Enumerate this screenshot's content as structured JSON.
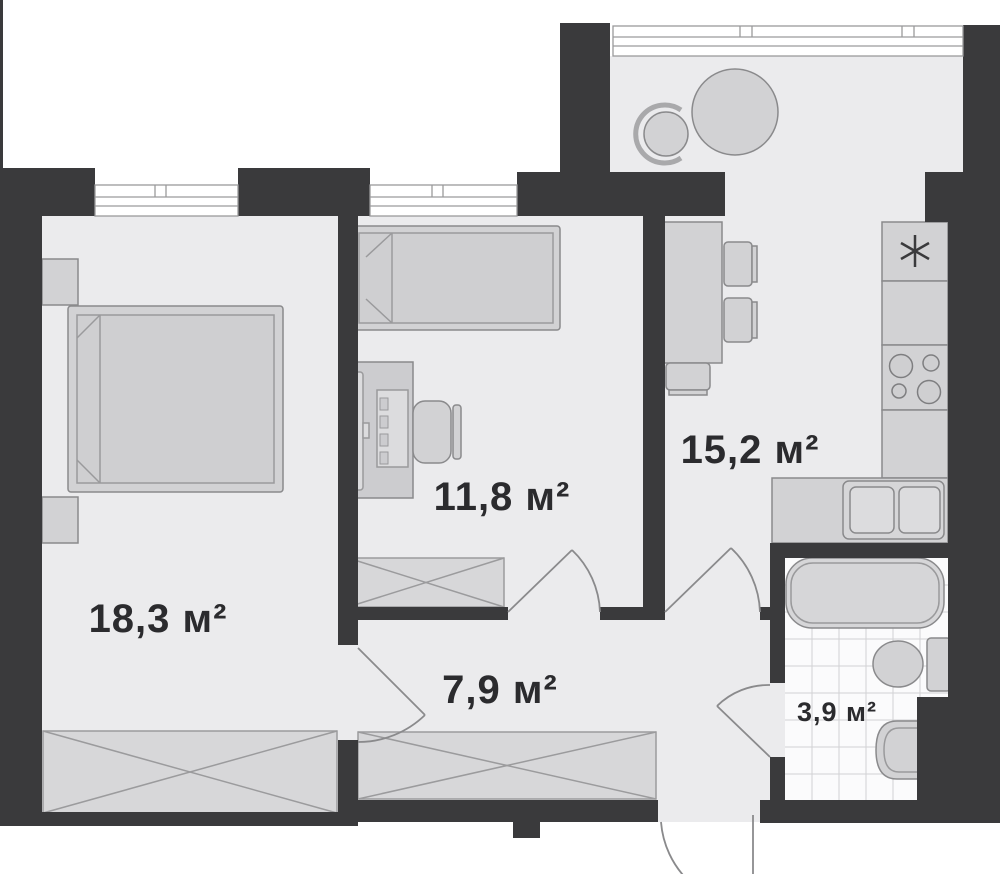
{
  "plan": {
    "type": "apartment-floor-plan",
    "colors": {
      "background": "#ffffff",
      "wall": "#3a3a3c",
      "floor": "#ebebed",
      "bathroom_floor": "#fbfbfc",
      "tile_line": "#d2d2d4",
      "furniture_fill": "#d2d2d4",
      "furniture_stroke": "#8a8a8c",
      "closet_fill": "#d7d7d9",
      "label_color": "#2b2b2e"
    },
    "rooms": [
      {
        "id": "bedroom",
        "area_label": "18,3 м²"
      },
      {
        "id": "office-bedroom",
        "area_label": "11,8 м²"
      },
      {
        "id": "kitchen-living",
        "area_label": "15,2 м²"
      },
      {
        "id": "hallway",
        "area_label": "7,9 м²"
      },
      {
        "id": "bathroom",
        "area_label": "3,9 м²"
      }
    ],
    "icons": {
      "fridge": "snowflake-icon",
      "stove": "four-burner-icon"
    }
  }
}
